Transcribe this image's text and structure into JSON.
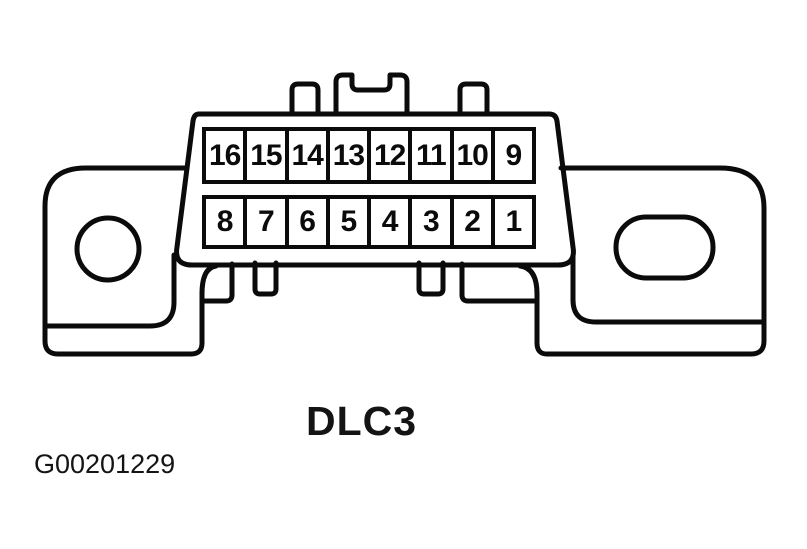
{
  "figure": {
    "connector_label": "DLC3",
    "figure_id": "G00201229",
    "pin_rows": {
      "top": [
        "16",
        "15",
        "14",
        "13",
        "12",
        "11",
        "10",
        "9"
      ],
      "bottom": [
        "8",
        "7",
        "6",
        "5",
        "4",
        "3",
        "2",
        "1"
      ]
    }
  },
  "colors": {
    "background": "#ffffff",
    "line": "#0b0b0b"
  }
}
